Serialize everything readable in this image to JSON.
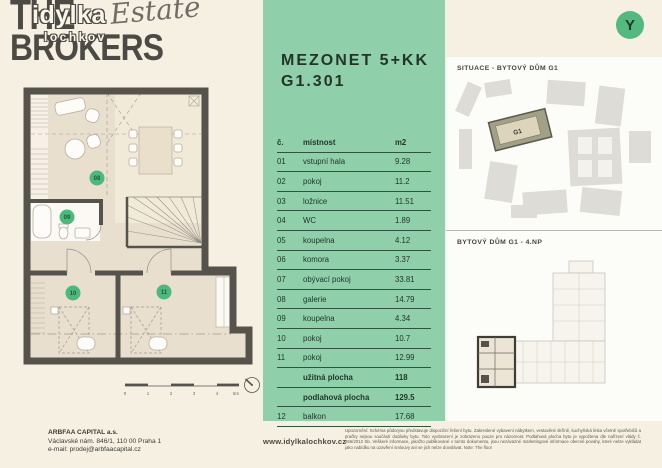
{
  "logo": {
    "line1": "THE",
    "line2": "BROKERS",
    "overlay_top": "idylka",
    "overlay_script": "Estate",
    "overlay_bottom": "lochkov"
  },
  "unit": {
    "type": "MEZONET 5+KK",
    "number": "G1.301"
  },
  "room_table": {
    "header": {
      "no": "č.",
      "room": "místnost",
      "area": "m2"
    },
    "rows": [
      {
        "no": "01",
        "room": "vstupní hala",
        "area": "9.28"
      },
      {
        "no": "02",
        "room": "pokoj",
        "area": "11.2"
      },
      {
        "no": "03",
        "room": "ložnice",
        "area": "11.51"
      },
      {
        "no": "04",
        "room": "WC",
        "area": "1.89"
      },
      {
        "no": "05",
        "room": "koupelna",
        "area": "4.12"
      },
      {
        "no": "06",
        "room": "komora",
        "area": "3.37"
      },
      {
        "no": "07",
        "room": "obývací pokoj",
        "area": "33.81"
      },
      {
        "no": "08",
        "room": "galerie",
        "area": "14.79"
      },
      {
        "no": "09",
        "room": "koupelna",
        "area": "4.34"
      },
      {
        "no": "10",
        "room": "pokoj",
        "area": "10.7"
      },
      {
        "no": "11",
        "room": "pokoj",
        "area": "12.99"
      },
      {
        "no": "",
        "room": "užitná plocha",
        "area": "118"
      },
      {
        "no": "",
        "room": "podlahová plocha",
        "area": "129.5"
      },
      {
        "no": "12",
        "room": "balkon",
        "area": "17.68"
      }
    ]
  },
  "floor_plan": {
    "badges": [
      "08",
      "09",
      "10",
      "11"
    ],
    "scale_labels": [
      "0",
      "1",
      "2",
      "3",
      "4",
      "5m"
    ]
  },
  "compass_letter": "Y",
  "situace": {
    "title": "SITUACE - BYTOVÝ DŮM G1",
    "building_label": "G1"
  },
  "floor_overview": {
    "title": "BYTOVÝ DŮM  G1 - 4.NP"
  },
  "footer": {
    "company": "ARBFAA CAPITAL a.s.",
    "address": "Václavské nám. 846/1, 110 00 Praha 1",
    "email": "e-mail: prodej@arbfaacapital.cz",
    "website": "www.idylkalochkov.cz",
    "disclaimer": "Upozornění: Schéma půdorysu představuje dispoziční řešení bytu. Zakreslené vybavení nábytkem, vestavěné skříně, kuchyňská linka včetně spotřebičů a pračky nejsou součástí dodávky bytu. Toto vyobrazení je zobrazeno pouze pro názornost. Podlahová plocha bytu je vypočtena dle nařízení vlády č. 366/2013 Sb. Veškeré informace, jakožto publikované v tomto dokumentu, jsou nezávazné marketingové informace obecné povahy, které nelze vykládat jako nabídku na uzavření smlouvy ani se jich nelze dovolávat. Note: The floor"
  }
}
